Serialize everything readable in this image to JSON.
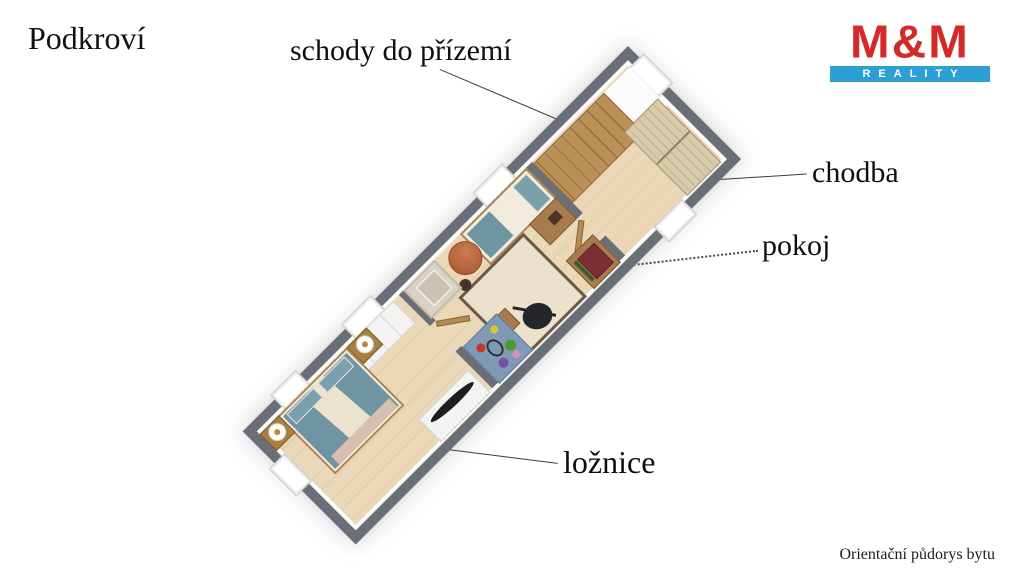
{
  "title": "Podkroví",
  "footnote": "Orientační půdorys bytu",
  "logo": {
    "name": "M&M",
    "tagline": "REALITY",
    "red": "#d32b27",
    "blue": "#2d9fd6"
  },
  "annotations": {
    "stairs": "schody do přízemí",
    "hallway": "chodba",
    "room": "pokoj",
    "bedroom": "ložnice"
  },
  "colors": {
    "wall_gray": "#6a6f77",
    "floor_wood": "#ead8b8",
    "stairs_wood": "#b98e55",
    "bedding_teal": "#6f94a2",
    "rug_beige": "#ece2cc",
    "suitcase_burgundy": "#7d2f34",
    "playmat_blue": "#7f9ab4"
  }
}
